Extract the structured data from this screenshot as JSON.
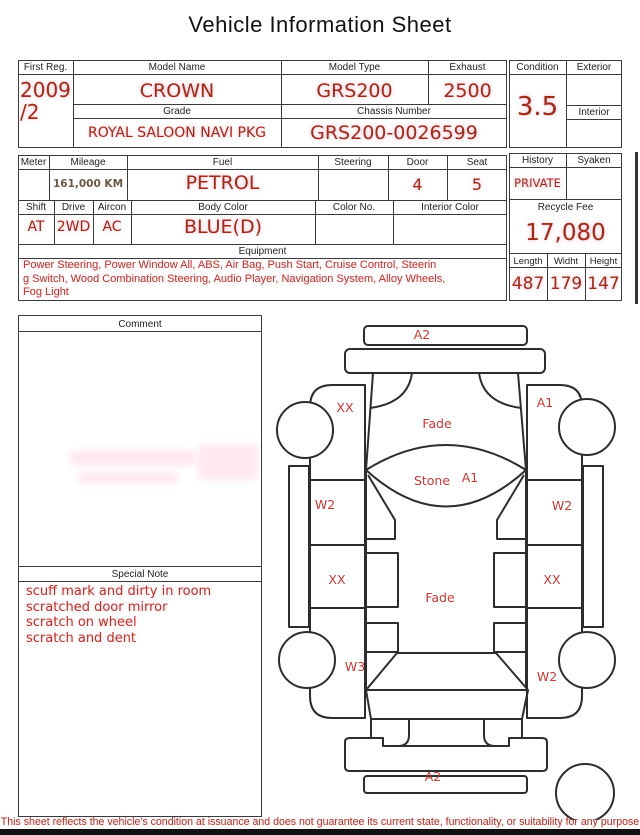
{
  "title": "Vehicle Information Sheet",
  "colors": {
    "value_red": "#9b2d1d",
    "note_red": "#b5342c",
    "line": "#3a3a3a",
    "mileage_brown": "#6b5844"
  },
  "table1": {
    "first_reg": {
      "label": "First Reg.",
      "value_line1": "2009",
      "value_line2": "/2"
    },
    "model_name": {
      "label": "Model Name",
      "value": "CROWN"
    },
    "model_type": {
      "label": "Model Type",
      "value": "GRS200"
    },
    "exhaust": {
      "label": "Exhaust",
      "value": "2500"
    },
    "grade": {
      "label": "Grade",
      "value": "ROYAL SALOON NAVI PKG"
    },
    "chassis_number": {
      "label": "Chassis Number",
      "value": "GRS200-0026599"
    },
    "condition": {
      "label": "Condition",
      "value": "3.5"
    },
    "exterior": {
      "label": "Exterior",
      "value": ""
    },
    "interior": {
      "label": "Interior",
      "value": ""
    }
  },
  "table2": {
    "meter": {
      "label": "Meter",
      "value": ""
    },
    "mileage": {
      "label": "Mileage",
      "value": "161,000 KM"
    },
    "fuel": {
      "label": "Fuel",
      "value": "PETROL"
    },
    "steering": {
      "label": "Steering",
      "value": ""
    },
    "door": {
      "label": "Door",
      "value": "4"
    },
    "seat": {
      "label": "Seat",
      "value": "5"
    },
    "shift": {
      "label": "Shift",
      "value": "AT"
    },
    "drive": {
      "label": "Drive",
      "value": "2WD"
    },
    "aircon": {
      "label": "Aircon",
      "value": "AC"
    },
    "body_color": {
      "label": "Body Color",
      "value": "BLUE(D)"
    },
    "color_no": {
      "label": "Color No.",
      "value": ""
    },
    "interior_color": {
      "label": "Interior Color",
      "value": ""
    },
    "equipment": {
      "label": "Equipment",
      "lines": [
        "Power Steering, Power Window  All, ABS, Air Bag, Push Start, Cruise Control, Steerin",
        "g Switch, Wood Combination Steering, Audio Player, Navigation System, Alloy Wheels,",
        "Fog Light"
      ]
    },
    "history": {
      "label": "History",
      "value": "PRIVATE"
    },
    "syaken": {
      "label": "Syaken",
      "value": ""
    },
    "recycle_fee": {
      "label": "Recycle Fee",
      "value": "17,080"
    },
    "length": {
      "label": "Length",
      "value": "487"
    },
    "width": {
      "label": "Widht",
      "value": "179"
    },
    "height": {
      "label": "Height",
      "value": "147"
    }
  },
  "comment": {
    "label": "Comment",
    "value": ""
  },
  "special_note": {
    "label": "Special Note",
    "lines": [
      "scuff mark and dirty in room",
      "scratched door mirror",
      "scratch on wheel",
      "scratch and dent"
    ]
  },
  "diagram": {
    "labels": [
      {
        "id": "front-bumper",
        "text": "A2"
      },
      {
        "id": "left-front-fender",
        "text": "XX"
      },
      {
        "id": "right-front-fender",
        "text": "A1"
      },
      {
        "id": "hood",
        "text": "Fade"
      },
      {
        "id": "windshield-stone",
        "text": "Stone"
      },
      {
        "id": "windshield-grade",
        "text": "A1"
      },
      {
        "id": "left-front-door",
        "text": "W2"
      },
      {
        "id": "right-front-door",
        "text": "W2"
      },
      {
        "id": "left-rear-door",
        "text": "XX"
      },
      {
        "id": "right-rear-door",
        "text": "XX"
      },
      {
        "id": "roof",
        "text": "Fade"
      },
      {
        "id": "left-rear-fender",
        "text": "W3"
      },
      {
        "id": "right-rear-fender",
        "text": "W2"
      },
      {
        "id": "rear-bumper",
        "text": "A2"
      }
    ]
  },
  "footer": "This sheet reflects the vehicle's condition at issuance and does not guarantee its current state, functionality, or suitability for any purpose"
}
